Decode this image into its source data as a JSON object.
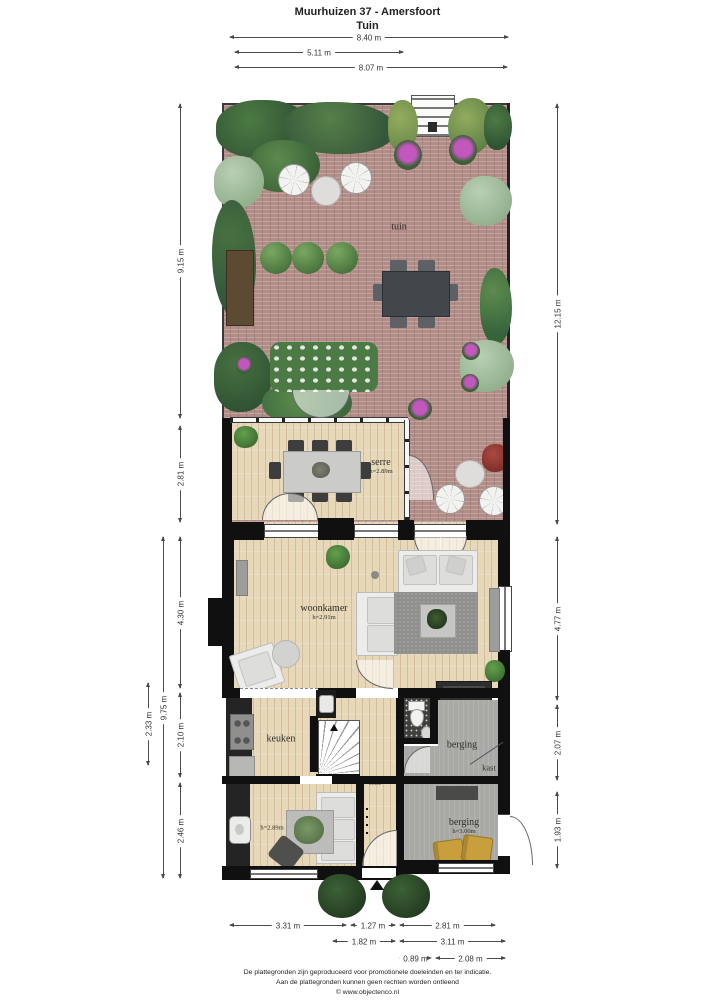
{
  "header": {
    "title": "Muurhuizen 37 - Amersfoort",
    "subtitle": "Tuin"
  },
  "rooms": {
    "tuin": {
      "label": "tuin"
    },
    "serre": {
      "label": "serre",
      "height": "h=2.89m"
    },
    "woonkamer": {
      "label": "woonkamer",
      "height": "h=2.91m"
    },
    "keuken": {
      "label": "keuken",
      "height": "h=2.62m"
    },
    "hal": {
      "label": "hal"
    },
    "berging_top": {
      "label": "berging"
    },
    "kast": {
      "label": "kast"
    },
    "berging_bottom": {
      "label": "berging",
      "height": "h=3.00m"
    },
    "kamer_onder": {
      "height": "h=2.89m"
    }
  },
  "dims": {
    "top": [
      {
        "label": "8.40 m"
      },
      {
        "label": "5.11 m"
      },
      {
        "label": "8.07 m"
      }
    ],
    "left_inner": [
      {
        "label": "9.15 m"
      },
      {
        "label": "2.81 m"
      },
      {
        "label": "4.30 m"
      },
      {
        "label": "2.10 m"
      },
      {
        "label": "2.46 m"
      }
    ],
    "left_outer": [
      {
        "label": "9.75 m"
      },
      {
        "label": "2.33 m"
      }
    ],
    "right": [
      {
        "label": "12.15 m"
      },
      {
        "label": "4.77 m"
      },
      {
        "label": "2.07 m"
      },
      {
        "label": "1.93 m"
      }
    ],
    "bottom_row1": [
      {
        "label": "3.31 m"
      },
      {
        "label": "1.27 m"
      },
      {
        "label": "2.81 m"
      }
    ],
    "bottom_row2": [
      {
        "label": "1.82 m"
      },
      {
        "label": "3.11 m"
      }
    ],
    "bottom_row3": [
      {
        "label": "0.89 m"
      },
      {
        "label": "2.08 m"
      }
    ]
  },
  "footer": {
    "line1": "De plattegronden zijn geproduceerd voor promotionele doeleinden en ter indicatie.",
    "line2": "Aan de plattegronden kunnen geen rechten worden ontleend",
    "line3": "© www.objectenco.nl"
  },
  "colors": {
    "wall": "#101010",
    "brick": "#b28d87",
    "wood": "#e7d8ba",
    "floor_gray": "#a9a9a6",
    "green_dark": "#35563a",
    "green_mid": "#4c7a44",
    "green_sage": "#a8c2a4",
    "accent_purple": "#c257bd",
    "accent_red": "#8e3838",
    "chair_gold": "#c89f3c"
  }
}
